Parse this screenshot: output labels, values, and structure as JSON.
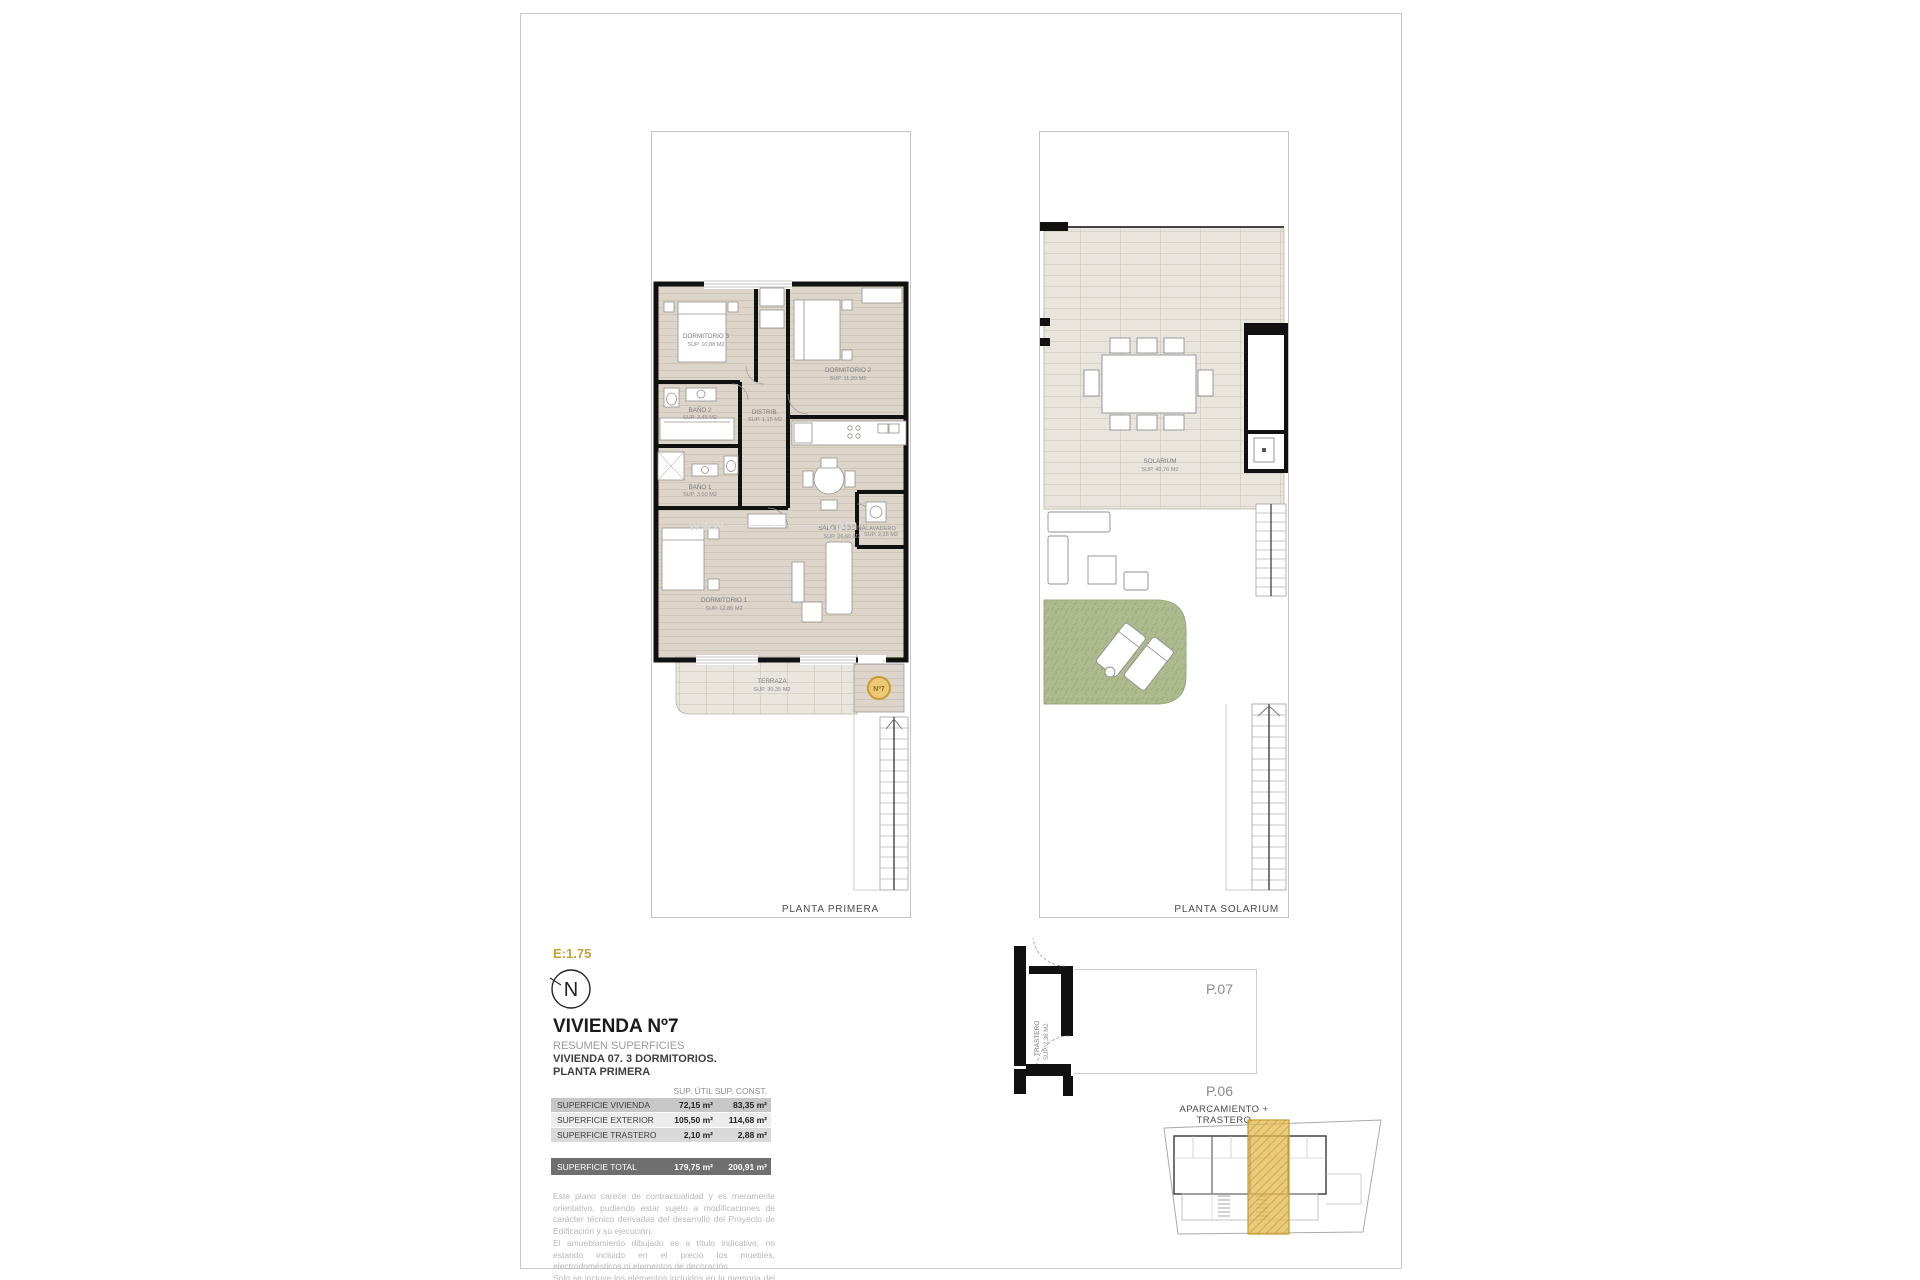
{
  "page": {
    "scale_label": "E:1.75",
    "watermark": "www.────────.com"
  },
  "north_label": "N",
  "plan_first": {
    "caption": "PLANTA PRIMERA",
    "unit_badge": "Nº7",
    "rooms": {
      "dorm3": {
        "name": "DORMITORIO 3",
        "area": "SUP. 10,88 M2"
      },
      "dorm2": {
        "name": "DORMITORIO 2",
        "area": "SUP. 11,20 M2"
      },
      "bath2": {
        "name": "BAÑO 2",
        "area": "SUP. 3,45 M2"
      },
      "distrib": {
        "name": "DISTRIB.",
        "area": "SUP. 1,15 M2"
      },
      "bath1": {
        "name": "BAÑO 1",
        "area": "SUP. 3,50 M2"
      },
      "dorm1": {
        "name": "DORMITORIO 1",
        "area": "SUP. 12,85 M2"
      },
      "salon": {
        "name": "SALÓN COCINA",
        "area": "SUP. 26,60 M2"
      },
      "lavadero": {
        "name": "LAVADERO",
        "area": "SUP. 2,35 M2"
      },
      "terraza": {
        "name": "TERRAZA",
        "area": "SUP. 30,35 M2"
      }
    }
  },
  "plan_solarium": {
    "caption": "PLANTA SOLARIUM",
    "rooms": {
      "solarium": {
        "name": "SOLARIUM",
        "area": "SUP. 40,76 M2"
      }
    }
  },
  "title_block": {
    "title": "VIVIENDA Nº7",
    "subtitle": "RESUMEN SUPERFICIES",
    "line1": "VIVIENDA 07. 3 DORMITORIOS.",
    "line2": "PLANTA PRIMERA"
  },
  "areas_table": {
    "col_util": "SUP. ÚTIL",
    "col_const": "SUP. CONST.",
    "rows": [
      {
        "label": "SUPERFICIE VIVIENDA",
        "util": "72,15 m²",
        "const": "83,35 m²"
      },
      {
        "label": "SUPERFICIE EXTERIOR",
        "util": "105,50 m²",
        "const": "114,68 m²"
      },
      {
        "label": "SUPERFICIE TRASTERO",
        "util": "2,10 m²",
        "const": "2,88 m²"
      }
    ],
    "total": {
      "label": "SUPERFICIE TOTAL",
      "util": "179,75 m²",
      "const": "200,91 m²"
    }
  },
  "disclaimer": {
    "p1": "Este plano carece de contractualidad y es meramente orientativo, pudiendo estar sujeto a modificaciones de carácter técnico derivadas del desarrollo del Proyecto de Edificación y su ejecución.",
    "p2": "El amueblamiento dibujado es a título indicativo, no estando incluido en el precio los muebles, electrodomésticos ni elementos de decoración.",
    "p3": "Solo se incluye los elementos incluidos en la memoria del Proyecto visado."
  },
  "parking": {
    "caption": "APARCAMIENTO + TRASTERO",
    "trastero_name": "TRASTERO",
    "trastero_area": "SUP. 2,36 M2",
    "space_top": "P.07",
    "space_bottom": "P.06"
  },
  "colors": {
    "accent_gold": "#C9A13B",
    "highlight_strip": "#E2B84F",
    "garden_green": "#ADBB8E",
    "wall": "#111111"
  }
}
